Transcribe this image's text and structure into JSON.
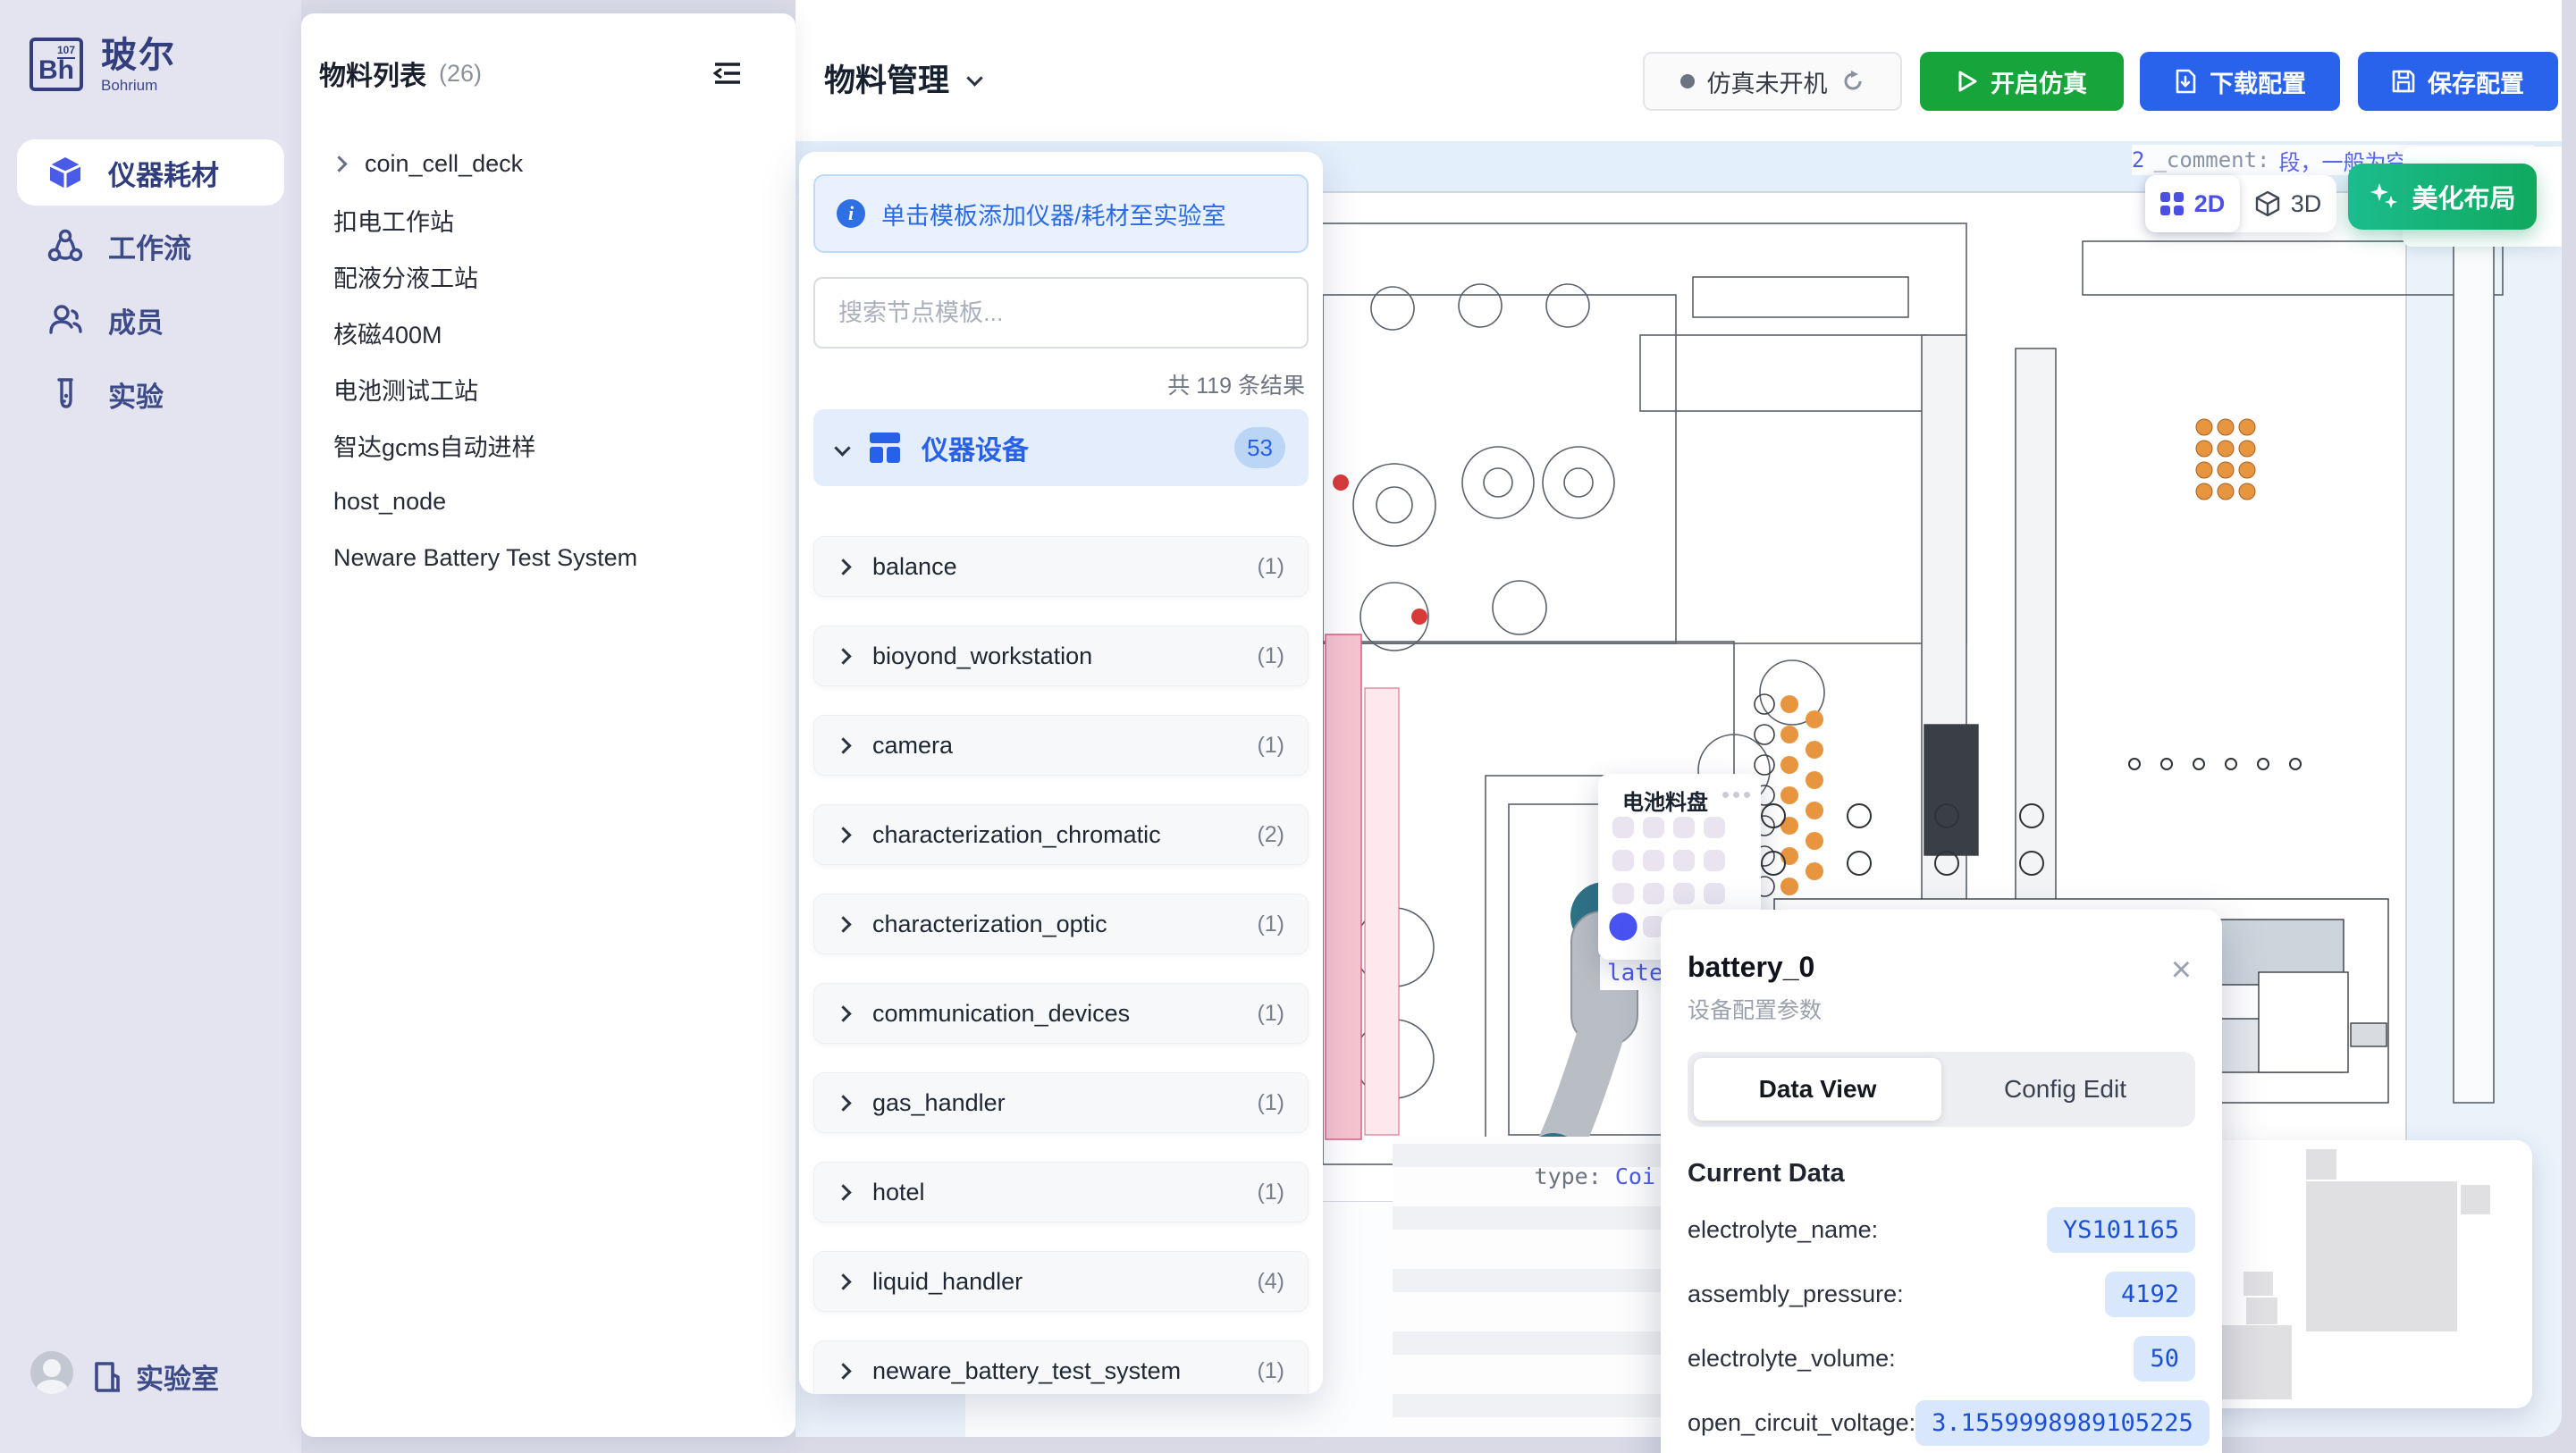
{
  "sidebar": {
    "logo": {
      "abbr": "Bh",
      "sup": "107",
      "title": "玻尔",
      "subtitle": "Bohrium"
    },
    "items": [
      {
        "label": "仪器耗材"
      },
      {
        "label": "工作流"
      },
      {
        "label": "成员"
      },
      {
        "label": "实验"
      }
    ],
    "footer": {
      "label": "实验室"
    }
  },
  "material_list": {
    "title": "物料列表",
    "count": "(26)",
    "items": [
      {
        "label": "coin_cell_deck"
      },
      {
        "label": "扣电工作站"
      },
      {
        "label": "配液分液工站"
      },
      {
        "label": "核磁400M"
      },
      {
        "label": "电池测试工站"
      },
      {
        "label": "智达gcms自动进样"
      },
      {
        "label": "host_node"
      },
      {
        "label": "Neware Battery Test System"
      }
    ]
  },
  "header": {
    "title": "物料管理",
    "status_label": "仿真未开机",
    "start_label": "开启仿真",
    "download_label": "下载配置",
    "save_label": "保存配置"
  },
  "template_panel": {
    "hint": "单击模板添加仪器/耗材至实验室",
    "search_placeholder": "搜索节点模板...",
    "result_count": "共 119 条结果",
    "category": {
      "label": "仪器设备",
      "count": "53"
    },
    "items": [
      {
        "name": "balance",
        "count": "(1)"
      },
      {
        "name": "bioyond_workstation",
        "count": "(1)"
      },
      {
        "name": "camera",
        "count": "(1)"
      },
      {
        "name": "characterization_chromatic",
        "count": "(2)"
      },
      {
        "name": "characterization_optic",
        "count": "(1)"
      },
      {
        "name": "communication_devices",
        "count": "(1)"
      },
      {
        "name": "gas_handler",
        "count": "(1)"
      },
      {
        "name": "hotel",
        "count": "(1)"
      },
      {
        "name": "liquid_handler",
        "count": "(4)"
      },
      {
        "name": "neware_battery_test_system",
        "count": "(1)"
      }
    ]
  },
  "canvas": {
    "toggle_2d": "2D",
    "toggle_3d": "3D",
    "beautify_label": "美化布局",
    "comment_lead": "2",
    "comment_label": "_comment:",
    "comment_value": "段，一般为空，stat",
    "right_fragment": "esou",
    "type_label": "type:",
    "type_value": "Coi",
    "plate_fragment": "late",
    "tray_popup": {
      "title": "电池料盘"
    }
  },
  "battery_popup": {
    "title": "battery_0",
    "subtitle": "设备配置参数",
    "tabs": [
      {
        "label": "Data View"
      },
      {
        "label": "Config Edit"
      }
    ],
    "section": "Current Data",
    "rows": [
      {
        "label": "electrolyte_name:",
        "value": "YS101165"
      },
      {
        "label": "assembly_pressure:",
        "value": "4192"
      },
      {
        "label": "electrolyte_volume:",
        "value": "50"
      },
      {
        "label": "open_circuit_voltage:",
        "value": "3.1559998989105225"
      },
      {
        "label": "data_electrolyte_code:",
        "value": "LG000014"
      }
    ]
  }
}
